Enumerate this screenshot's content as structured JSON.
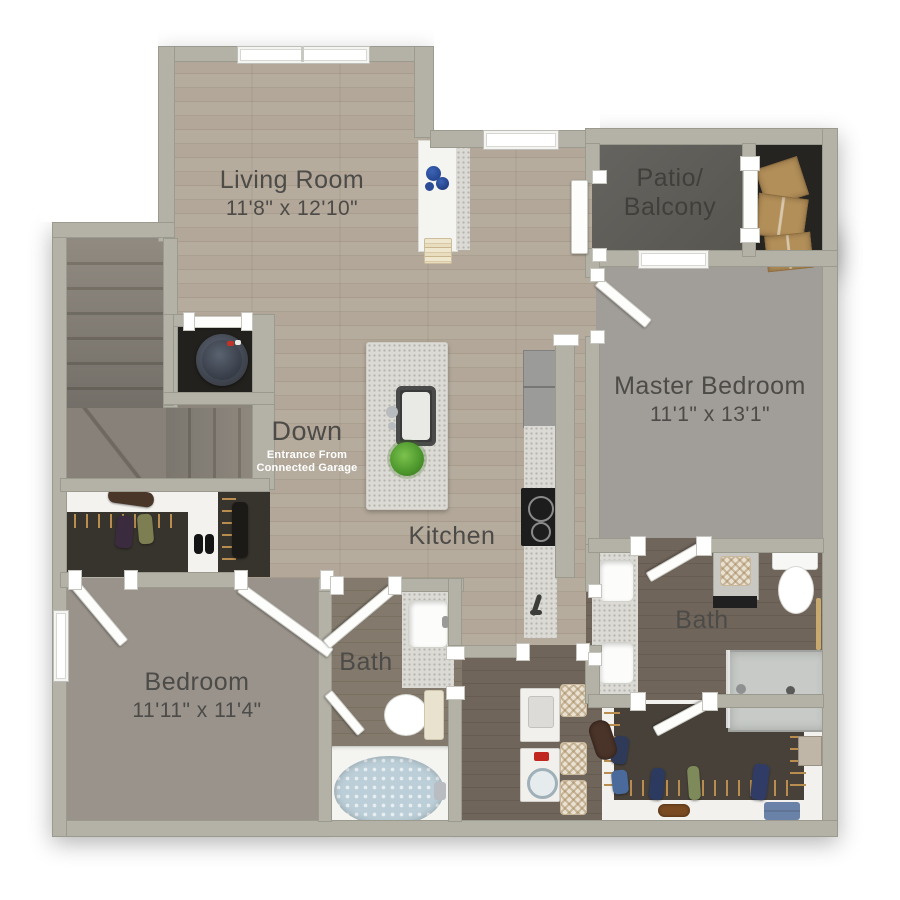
{
  "plan_title": "2 Bed / 2 Bath Floor Plan",
  "rooms": {
    "living_room": {
      "name": "Living Room",
      "dims": "11'8\" x 12'10\""
    },
    "patio": {
      "name_line1": "Patio/",
      "name_line2": "Balcony"
    },
    "master_bedroom": {
      "name": "Master Bedroom",
      "dims": "11'1\" x 13'1\""
    },
    "stairs": {
      "label": "Down",
      "note_line1": "Entrance From",
      "note_line2": "Connected Garage"
    },
    "kitchen": {
      "name": "Kitchen"
    },
    "bath_main": {
      "name": "Bath"
    },
    "bath_master": {
      "name": "Bath"
    },
    "bedroom": {
      "name": "Bedroom",
      "dims": "11'11\" x 11'4\""
    }
  },
  "colors": {
    "wall": "#b4b2a7",
    "wood_floor": "#b0a595",
    "dark_wood_floor": "#6b6157",
    "carpet": "#9c968e",
    "patio_concrete": "#5e5c57",
    "label_text": "#4c4b48",
    "note_text": "#ffffff",
    "tub_water": "#bccfd8",
    "plant_green": "#56a238",
    "cardboard": "#b28e58"
  }
}
